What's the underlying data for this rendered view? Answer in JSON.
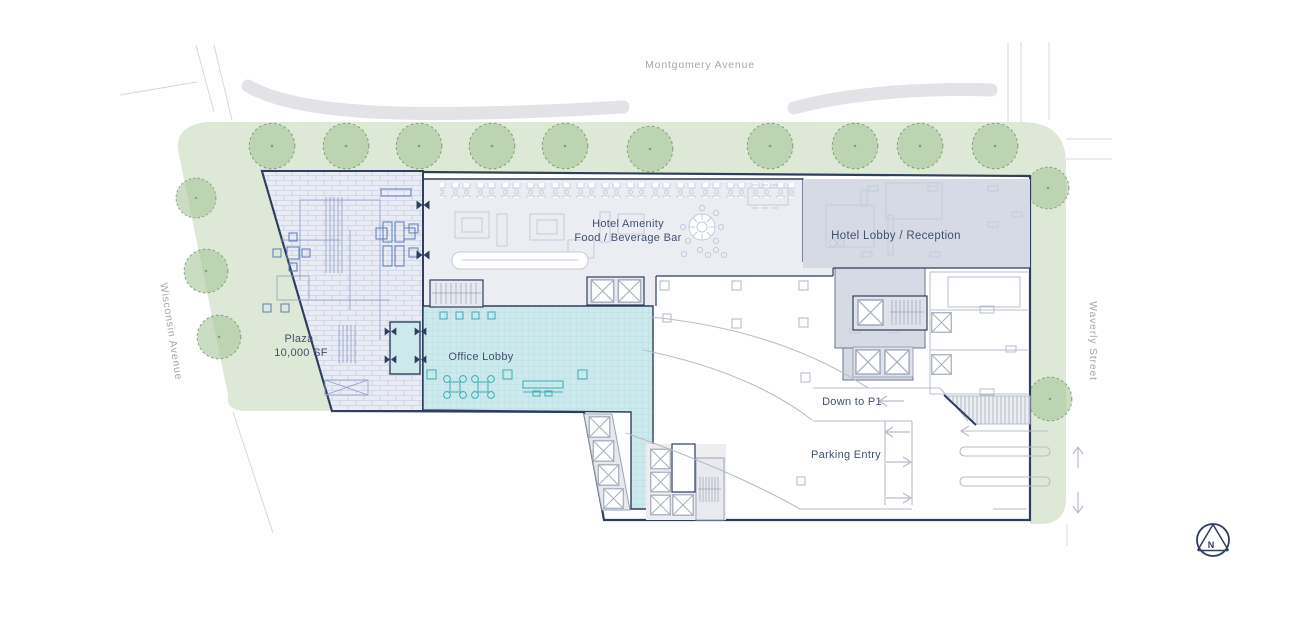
{
  "streets": {
    "top": "Montgomery Avenue",
    "left": "Wisconsin Avenue",
    "right": "Waverly Street"
  },
  "areas": {
    "plaza_name": "Plaza",
    "plaza_size": "10,000 SF",
    "amenity_line1": "Hotel Amenity",
    "amenity_line2": "Food / Beverage Bar",
    "hotel_lobby": "Hotel Lobby / Reception",
    "office_lobby": "Office Lobby"
  },
  "parking": {
    "ramp": "Down to P1",
    "entry": "Parking Entry"
  },
  "compass": {
    "north": "N"
  },
  "colors": {
    "building_outline": "#2f3e5e",
    "landscape": "#dde9d6",
    "tree": "#a9c69d",
    "plaza_fill": "#e9ecf5",
    "amenity_fill": "#ecedf3",
    "hotel_lobby_fill": "#d5dae5",
    "office_lobby_fill": "#cde9ec",
    "label_text": "#42506e",
    "street_text": "#a2a8b0"
  }
}
